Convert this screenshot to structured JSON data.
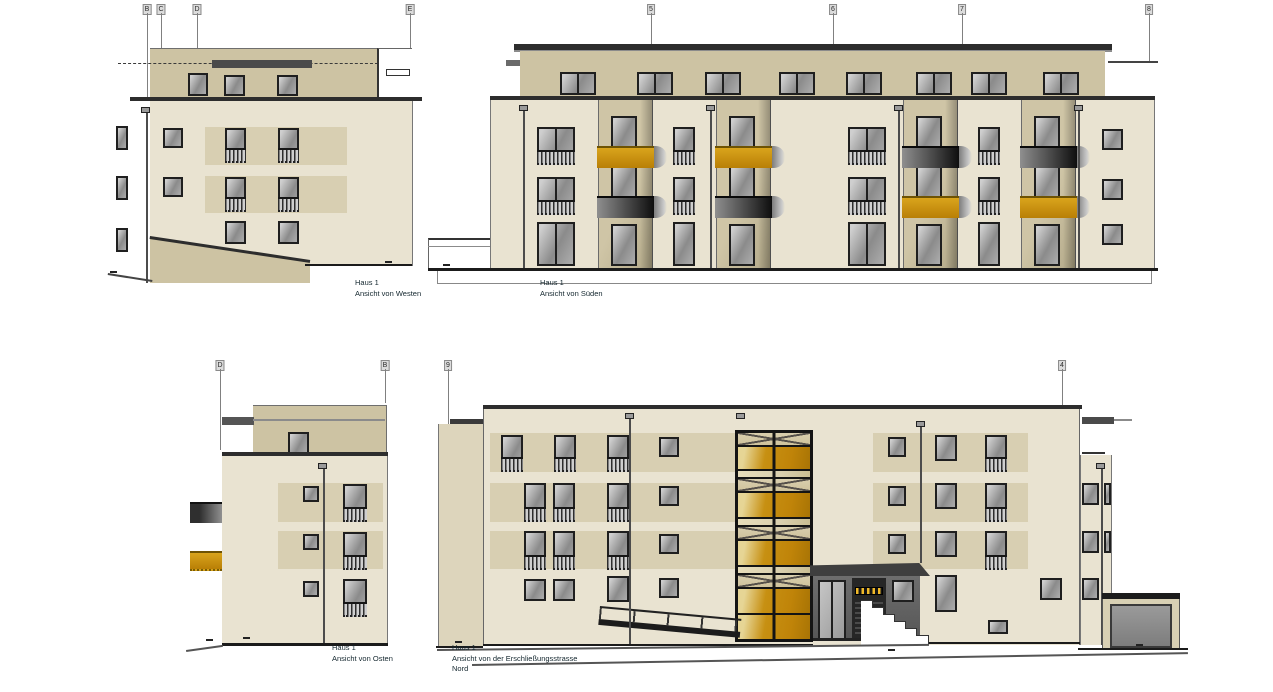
{
  "drawing": {
    "building": "Haus 1",
    "views": {
      "west": {
        "title": "Haus 1",
        "subtitle": "Ansicht von Westen",
        "markers": [
          "B",
          "C",
          "D",
          "E"
        ]
      },
      "sued": {
        "title": "Haus 1",
        "subtitle": "Ansicht von Süden",
        "markers": [
          "5",
          "6",
          "7",
          "8"
        ]
      },
      "ost": {
        "title": "Haus 1",
        "subtitle": "Ansicht von Osten",
        "markers": [
          "D",
          "B"
        ]
      },
      "nord": {
        "title": "Haus 1",
        "subtitle": "Ansicht von der Erschließungsstrasse",
        "subtitle2": "Nord",
        "markers": [
          "9",
          "4"
        ]
      }
    },
    "palette": {
      "facade_cream": "#e9e3d1",
      "window_band_beige": "#d8cfb2",
      "penthouse_tan": "#cdc3a3",
      "roof_dark": "#2d2d2d",
      "balcony_gold": "#c8920c",
      "balcony_gray": "#555555",
      "glass_gray": "#8b8b8b",
      "frame_dark": "#1f1f1f",
      "tower_gold": "#c79012"
    }
  }
}
